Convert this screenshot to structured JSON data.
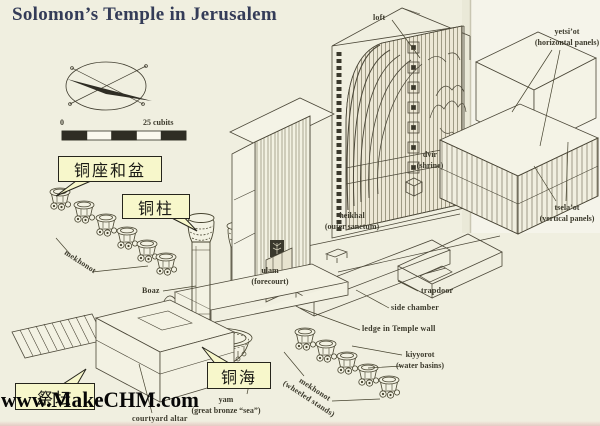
{
  "page": {
    "title": "Solomon’s Temple in Jerusalem",
    "watermark": "www.MakeCHM.com",
    "background_color": "#f0efe0",
    "ink_color": "#4b4738",
    "title_color": "#343c58",
    "callout_bg_color": "#f7f7cb"
  },
  "scale_bar": {
    "start_label": "0",
    "end_label": "25 cubits"
  },
  "compass": {
    "icon": "compass-needle"
  },
  "callouts": {
    "stands_and_basins": "铜座和盆",
    "pillar": "铜柱",
    "bronze_sea": "铜海",
    "altar": "祭坛"
  },
  "labels": {
    "loft": "loft",
    "yetsiot": {
      "name": "yetsi’ot",
      "desc": "(horizontal panels)"
    },
    "dvir": {
      "name": "dvir",
      "desc": "(shrine)"
    },
    "heikhal": {
      "name": "heikhal",
      "desc": "(outer sanctum)"
    },
    "tselaot": {
      "name": "tsela’ot",
      "desc": "(vertical panels)"
    },
    "ulam": {
      "name": "ulam",
      "desc": "(forecourt)"
    },
    "trapdoor": "trapdoor",
    "side_chamber": "side chamber",
    "ledge": "ledge in Temple wall",
    "kiyyorot": {
      "name": "kiyyorot",
      "desc": "(water basins)"
    },
    "mekhonot_left": "mekhonot",
    "mekhonot_right": {
      "name": "mekhonot",
      "desc": "(wheeled stands)"
    },
    "boaz": "Boaz",
    "yam": {
      "name": "yam",
      "desc": "(great bronze “sea”)"
    },
    "courtyard_altar": "courtyard altar"
  }
}
